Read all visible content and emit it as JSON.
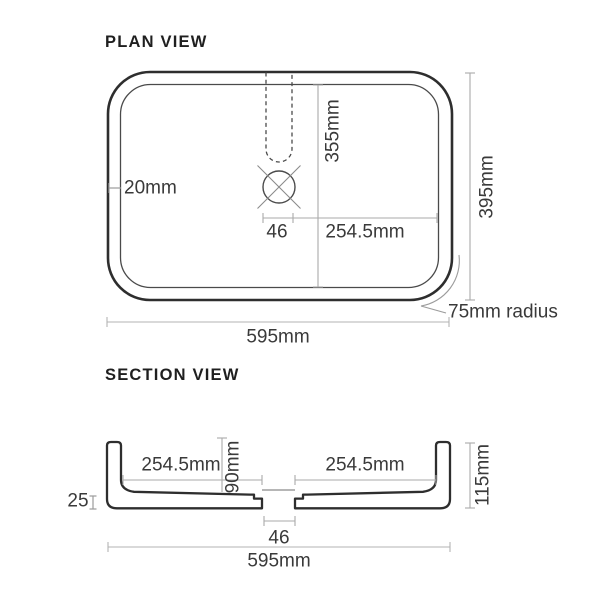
{
  "drawing": {
    "plan": {
      "title": "PLAN VIEW",
      "wall_thickness": "20mm",
      "inner_length": "355mm",
      "drain_width": "46",
      "drain_to_wall": "254.5mm",
      "overall_depth": "395mm",
      "overall_width": "595mm",
      "corner_radius": "75mm radius"
    },
    "section": {
      "title": "SECTION VIEW",
      "left_half": "254.5mm",
      "bowl_depth": "90mm",
      "right_half": "254.5mm",
      "overall_height": "115mm",
      "base_thickness": "25",
      "drain_width": "46",
      "overall_width": "595mm"
    },
    "colors": {
      "outline": "#2e2e2e",
      "secondary_outline": "#4a4a4a",
      "dimension_line": "#a6a6a6",
      "text": "#3a3a3a"
    }
  }
}
